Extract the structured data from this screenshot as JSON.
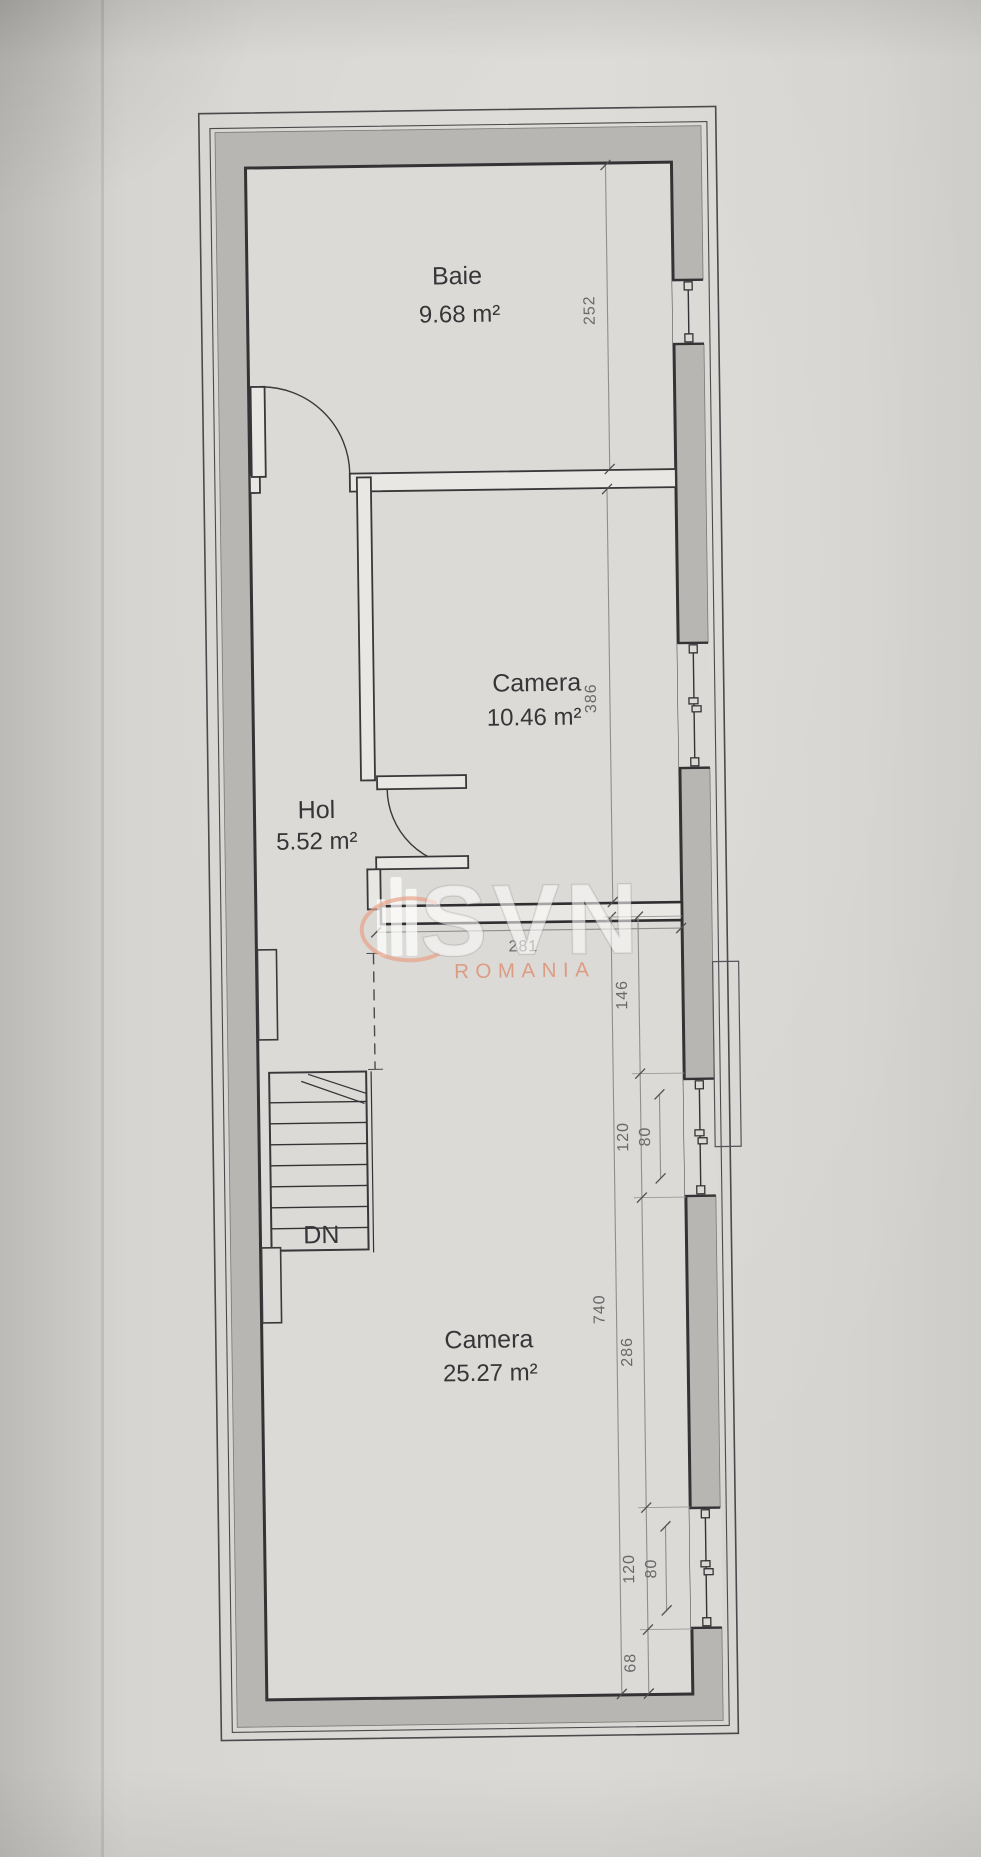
{
  "watermark": {
    "brand": "SVN",
    "region": "ROMANIA"
  },
  "rooms": [
    {
      "name": "Baie",
      "area": "9.68 m²"
    },
    {
      "name": "Camera",
      "area": "10.46 m²"
    },
    {
      "name": "Hol",
      "area": "5.52 m²"
    },
    {
      "name": "Camera",
      "area": "25.27 m²"
    }
  ],
  "stairs": {
    "label": "DN"
  },
  "dims": {
    "baie_depth": "252",
    "camera_upper_depth": "386",
    "lower_room_width": "281",
    "wall_seg_upper": "146",
    "window_upper": "120",
    "window_upper_glass": "80",
    "total_depth": "740",
    "wall_seg_mid": "286",
    "window_lower": "120",
    "window_lower_glass": "80",
    "wall_seg_bottom": "68"
  },
  "colors": {
    "watermark_accent": "#e09478",
    "wall_fill": "#b8b6b2",
    "line_dark": "#333335",
    "paper": "#dad8d4"
  }
}
